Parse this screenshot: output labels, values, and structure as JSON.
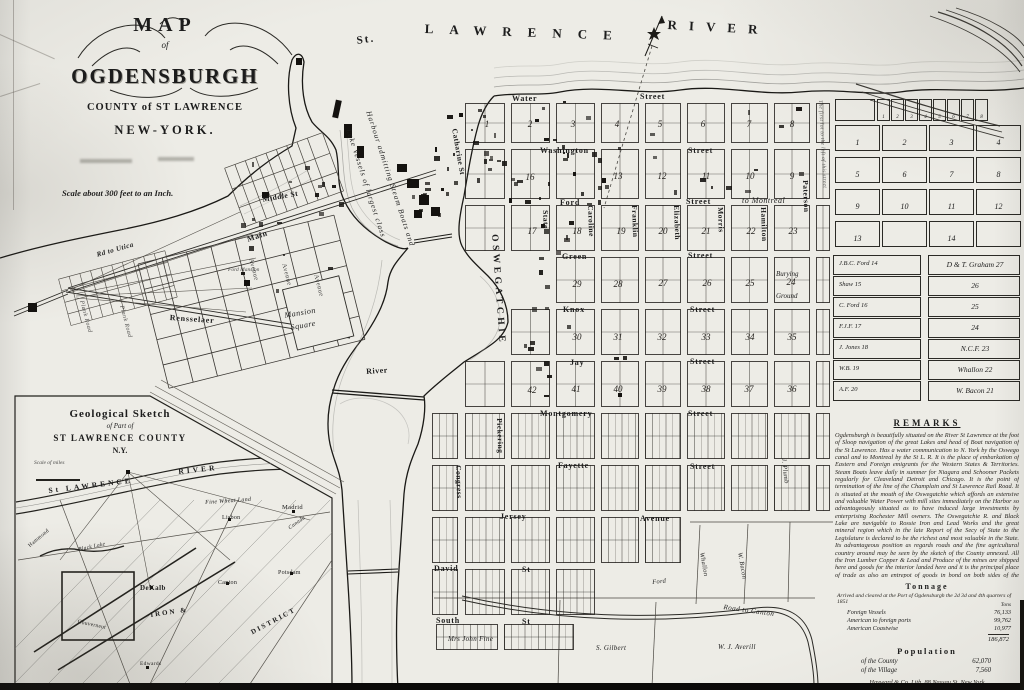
{
  "title_block": {
    "map": "MAP",
    "of": "of",
    "city": "OGDENSBURGH",
    "county": "COUNTY of ST LAWRENCE",
    "state": "NEW-YORK.",
    "scale_note": "Scale about 300 feet to an Inch."
  },
  "map_labels": {
    "st_l_st": "St.",
    "lawrence": "LAWRENCE",
    "river_big": "RIVER",
    "oswegatchie": "OSWEGATCHIE",
    "harbor1": "Harbour admitting Steam Boats and",
    "harbor2": "Lake Vessels of largest class",
    "water_w": "Water",
    "water_s": "Street",
    "wash_w": "Washington",
    "wash_s": "Street",
    "ford_w": "Ford",
    "ford_s": "Street",
    "montreal": "to Montreal",
    "green_w": "Green",
    "green_s": "Street",
    "knox_w": "Knox",
    "knox_s": "Street",
    "jay_w": "Jay",
    "jay_s": "Street",
    "mont_w": "Montgomery",
    "mont_s": "Street",
    "fay_w": "Fayette",
    "fay_s": "Street",
    "jersey_w": "Jersey",
    "jersey_s": "Avenue",
    "david_w": "David",
    "david_s": "St",
    "south_w": "South",
    "south_s": "St",
    "state": "State",
    "caroline": "Caroline",
    "franklin": "Franklin",
    "elizabeth": "Elizabeth",
    "morris": "Morris",
    "hamilton": "Hamilton",
    "paterson": "Paterson",
    "catharine": "Catharine St",
    "pickering": "Pickering",
    "congress": "Congress",
    "river_st": "River",
    "middle": "Middle St",
    "main": "Main",
    "rensselaer": "Rensselaer",
    "mansion1": "Mansion",
    "mansion2": "Square",
    "ford_mansion": "Ford Mansion",
    "utica": "Rd to Utica",
    "plank1": "Plank Road",
    "plank2": "Plank Road",
    "ave1": "Avenue",
    "ave2": "Avenue",
    "ave3": "Avenue",
    "burying1": "Burying",
    "burying2": "Ground",
    "fine": "Mrs John Fine",
    "gilbert": "S. Gilbert",
    "averill": "W. J. Averill",
    "canton_rd": "Road to Canton",
    "plumb": "J. Plumb",
    "whallon_v": "Whallon",
    "bacon_v": "W. Bacon",
    "ford_lot": "Ford",
    "note_right": "The first lot to the left of this street",
    "in_stl": "St LAWRENCE",
    "in_riv": "RIVER",
    "in_wheat": "Fine Wheat Land",
    "in_lisbon": "Lisbon",
    "in_madrid": "Madrid",
    "in_canada": "Canada",
    "in_dekalb": "DeKalb",
    "in_canton": "Canton",
    "in_potsdam": "Potsdam",
    "in_iron": "IRON &",
    "in_district": "DISTRICT",
    "in_gouv": "Gouverneur",
    "in_edwards": "Edwards",
    "in_hammond": "Hammond",
    "in_blacklake": "Black Lake"
  },
  "blocks_east": [
    "1",
    "2",
    "3",
    "4",
    "5",
    "6",
    "7",
    "8",
    "16",
    "13",
    "12",
    "11",
    "10",
    "9",
    "17",
    "18",
    "19",
    "20",
    "21",
    "22",
    "23",
    "29",
    "28",
    "27",
    "26",
    "25",
    "24",
    "30",
    "31",
    "32",
    "33",
    "34",
    "35",
    "42",
    "41",
    "40",
    "39",
    "38",
    "37",
    "36"
  ],
  "right_panel": {
    "strip_numbers": [
      "1",
      "2",
      "3",
      "4",
      "5",
      "6",
      "7",
      "8"
    ],
    "grid_numbers": [
      [
        "1",
        "2",
        "3",
        "4"
      ],
      [
        "5",
        "6",
        "7",
        "8"
      ],
      [
        "9",
        "10",
        "11",
        "12"
      ],
      [
        "13",
        "",
        "14",
        ""
      ]
    ],
    "owners_left": [
      "J.B.C. Ford 14",
      "Shaw 15",
      "C. Ford 16",
      "F.J.F. 17",
      "J. Jones 18",
      "W.B. 19",
      "A.F. 20"
    ],
    "owners_right": [
      "D & T. Graham 27",
      "26",
      "25",
      "24",
      "N.C.F. 23",
      "Whallon 22",
      "W. Bacon 21"
    ],
    "remarks_title": "REMARKS",
    "remarks_text": "Ogdensburgh is beautifully situated on the River St Lawrence at the foot of Sloop navigation of the great Lakes and head of Boat navigation of the St Lawrence. Has a water communication to N. York by the Oswego canal and to Montreal by the St L. R. It is the place of embarkation of Eastern and Foreign emigrants for the Western States & Territories. Steam Boats leave daily in summer for Niagara and Schooner Packets regularly for Cleaveland Detroit and Chicago. It is the point of termination of the line of the Champlain and St Lawrence Rail Road. It is situated at the mouth of the Oswegatchie which affords an extensive and valuable Water Power with mill sites immediately on the Harbor so advantageously situated as to have induced large investments by enterprising Rochester Mill owners. The Oswegatchie R. and Black Lake are navigable to Rossie Iron and Lead Works and the great mineral region which in the late Report of the Secy of State to the Legislature is declared to be the richest and most valuable in the State. Its advantageous position as regards roads and the fine agricultural country around may be seen by the sketch of the County annexed. All the Iron Lumber Copper & Lead and Produce of the mines are shipped here and goods for the interior landed here and it is the principal place of trade as also an entrepot of goods in bond on both sides of the American frontier.",
    "tonnage_title": "Tonnage",
    "tonnage_intro": "Arrived and cleared at the Port of Ogdensburgh the 2d 3d and 4th quarters of 1851",
    "tonnage_col_header": "Tons",
    "tonnage_rows": [
      {
        "label": "Foreign Vessels",
        "value": "76,133"
      },
      {
        "label": "American to foreign ports",
        "value": "99,762"
      },
      {
        "label": "American Coastwise",
        "value": "10,977"
      }
    ],
    "tonnage_total": "186,872",
    "population_title": "Population",
    "population_rows": [
      {
        "label": "of the County",
        "value": "62,070"
      },
      {
        "label": "of the Village",
        "value": "7,560"
      }
    ],
    "credit": "Hayward & Co. Lith. 88 Nassau St. New York"
  },
  "inset": {
    "title1": "Geological Sketch",
    "title2": "of Part of",
    "title3": "ST LAWRENCE COUNTY",
    "title4": "N.Y.",
    "scale": "Scale of miles"
  },
  "colors": {
    "ink": "#1c1c1c",
    "paper": "#edece6",
    "shade": "#8a8a86"
  }
}
